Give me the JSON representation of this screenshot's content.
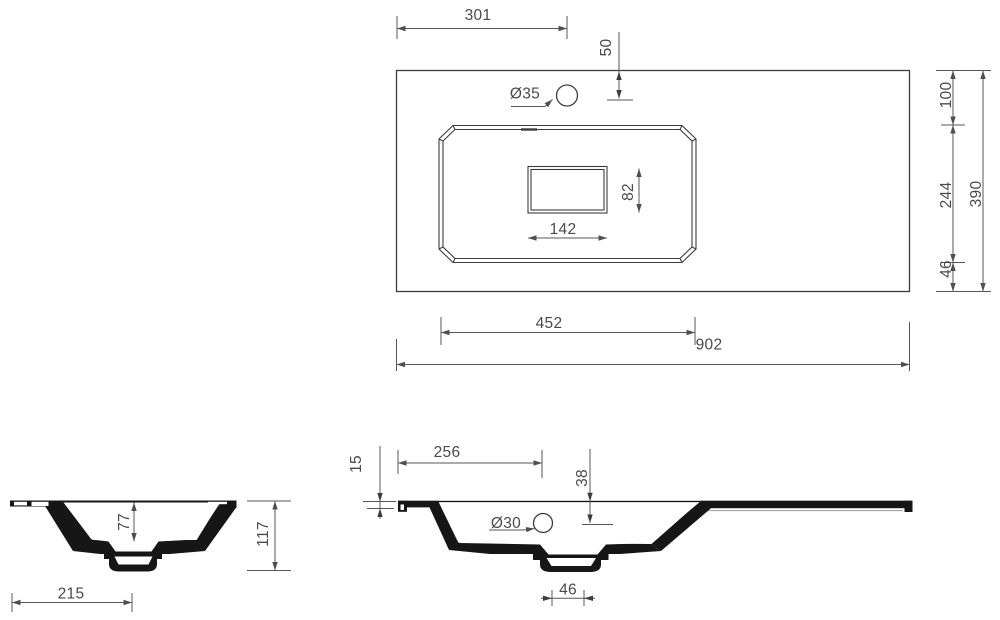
{
  "drawing_title": "Washbasin technical dimension drawing",
  "units": "mm",
  "colors": {
    "line": "#3c3c3c",
    "dim": "#575757",
    "ink": "#161616",
    "text": "#4a4a4a"
  },
  "top_view": {
    "left_edge_to_faucet": "301",
    "faucet_offset_from_back_edge": "50",
    "faucet_hole_diameter": "Ø35",
    "drain_cutout_width": "142",
    "drain_cutout_height": "82",
    "back_edge_to_basin": "100",
    "basin_front_to_back": "244",
    "basin_to_front_edge": "46",
    "total_depth": "390",
    "basin_width": "452",
    "total_width": "902"
  },
  "side_view": {
    "bowl_depth": "77",
    "total_height": "117",
    "edge_to_drain_center": "215"
  },
  "front_view": {
    "left_edge_to_overflow": "256",
    "rim_thickness": "15",
    "overflow_offset_from_top": "38",
    "overflow_hole_diameter": "Ø30",
    "drain_stub_width": "46"
  }
}
